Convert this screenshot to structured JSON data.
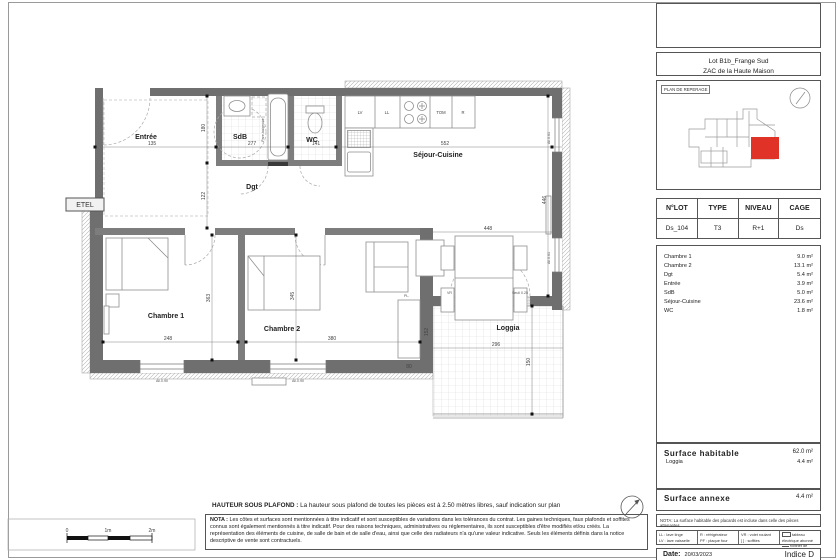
{
  "plan": {
    "rooms": {
      "entree": "Entrée",
      "sdb": "SdB",
      "wc": "WC",
      "dgt": "Dgt",
      "sejour": "Séjour-Cuisine",
      "ch1": "Chambre 1",
      "ch2": "Chambre 2",
      "loggia": "Loggia"
    },
    "kitchen": {
      "lv": "LV",
      "ll": "LL",
      "tom": "TOM",
      "r": "R"
    },
    "annotations": {
      "etel": "ETEL",
      "pl": "PL.",
      "vr": "VR",
      "seuil": "Seuil 0.25",
      "pare": "Pare-baignoire",
      "all61": "All.0.61",
      "all90": "All.0.90"
    },
    "dims": {
      "entree_w": "135",
      "sdb_w": "277",
      "sdb_h": "180",
      "wc_w": "141",
      "dgt_h": "122",
      "sejour_w": "552",
      "sejour_h": "446",
      "sejour_b": "448",
      "ch1_w": "248",
      "ch1_h": "363",
      "ch2_w": "380",
      "ch2_h": "345",
      "loggia_w": "296",
      "loggia_h": "150",
      "pl_h": "152",
      "pl_w": "80"
    }
  },
  "scale_bar": {
    "l0": "0",
    "l1": "1m",
    "l2": "2m"
  },
  "notes": {
    "ceiling_label": "HAUTEUR SOUS PLAFOND :",
    "ceiling_text": " La hauteur sous plafond de toutes les pièces est à 2.50 mètres libres, sauf indication sur plan",
    "nota_label": "NOTA :",
    "nota_text": " Les côtes et surfaces sont mentionnées à titre indicatif et sont susceptibles de variations dans les tolérances du contrat. Les gaines techniques, faux plafonds et soffites connus sont également mentionnés à titre indicatif. Pour des raisons techniques, administratives ou réglementaires, ils sont susceptibles d'être modifiés et/ou créés. La représentation des éléments de cuisine, de salle de bain et de salle d'eau, ainsi que celle des radiateurs n'a qu'une valeur indicative. Seuls les éléments définis dans la notice descriptive de vente sont contractuels."
  },
  "title_block": {
    "project_line1": "Lot B1b_Frange Sud",
    "project_line2": "ZAC de la Haute Maison",
    "reperage_label": "PLAN DE REPERAGE",
    "lot_table": {
      "headers": [
        "N°LOT",
        "TYPE",
        "NIVEAU",
        "CAGE"
      ],
      "values": [
        "Ds_104",
        "T3",
        "R+1",
        "Ds"
      ]
    },
    "areas": [
      {
        "label": "Chambre 1",
        "value": "9.0 m²"
      },
      {
        "label": "Chambre 2",
        "value": "13.1 m²"
      },
      {
        "label": "Dgt",
        "value": "5.4 m²"
      },
      {
        "label": "Entrée",
        "value": "3.9 m²"
      },
      {
        "label": "SdB",
        "value": "5.0 m²"
      },
      {
        "label": "Séjour-Cuisine",
        "value": "23.6 m²"
      },
      {
        "label": "WC",
        "value": "1.8 m²"
      }
    ],
    "surface_habitable": {
      "label": "Surface  habitable",
      "value": "62.0 m²",
      "sub_label": "Loggia",
      "sub_value": "4.4 m²"
    },
    "surface_annexe": {
      "label": "Surface  annexe",
      "value": "4.4 m²"
    },
    "nota_small": "NOTA: La surface habitable des placards est incluse dans celle des pièces attenantes",
    "legend": {
      "col1a": "LL : lave linge",
      "col1b": "LV : lave vaisselle",
      "col2a": "R : réfrigérateur",
      "col2b": "PF : plaque four",
      "col3a": "VR : volet roulant",
      "col3b": "[  ] : soffites",
      "col4a": "tableau électrique abonné",
      "col4b": "robinet de puisage"
    },
    "date_label": "Date:",
    "date_value": "20/03/2023",
    "indice": "Indice D"
  },
  "colors": {
    "highlight_red": "#e03227",
    "wall_gray": "#6f6f6f"
  }
}
